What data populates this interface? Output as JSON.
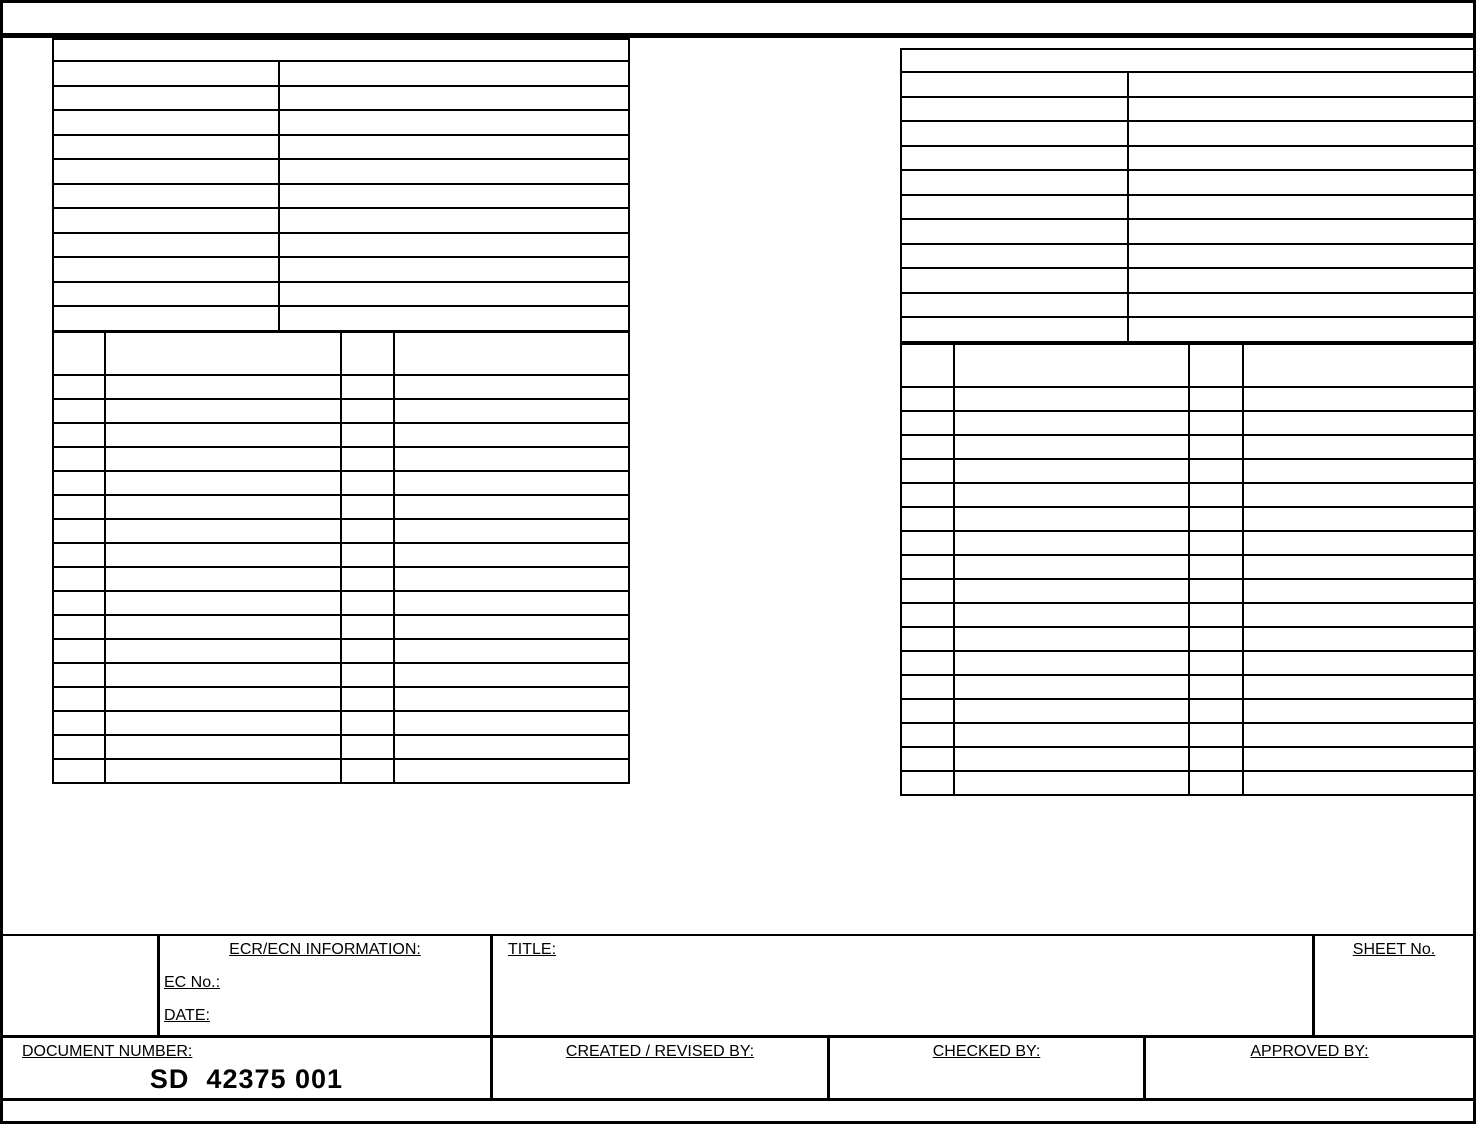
{
  "page": {
    "background": "#ffffff",
    "line_color": "#000000"
  },
  "tables": {
    "left_upper": {
      "header_rows": 1,
      "data_rows": 11,
      "columns": 2
    },
    "left_lower": {
      "header_rows": 1,
      "data_rows": 17,
      "columns": 4
    },
    "right_upper": {
      "header_rows": 1,
      "data_rows": 11,
      "columns": 2
    },
    "right_lower": {
      "header_rows": 1,
      "data_rows": 17,
      "columns": 4
    }
  },
  "footer": {
    "ecr_section": {
      "title": "ECR/ECN INFORMATION:",
      "ec_no_label": "EC No.:",
      "date_label": "DATE:"
    },
    "title_label": "TITLE:",
    "sheet_no_label": "SHEET No.",
    "document_number_label": "DOCUMENT NUMBER:",
    "document_number_value": "SD  42375 001",
    "created_by_label": "CREATED / REVISED BY:",
    "checked_by_label": "CHECKED BY:",
    "approved_by_label": "APPROVED BY:"
  }
}
